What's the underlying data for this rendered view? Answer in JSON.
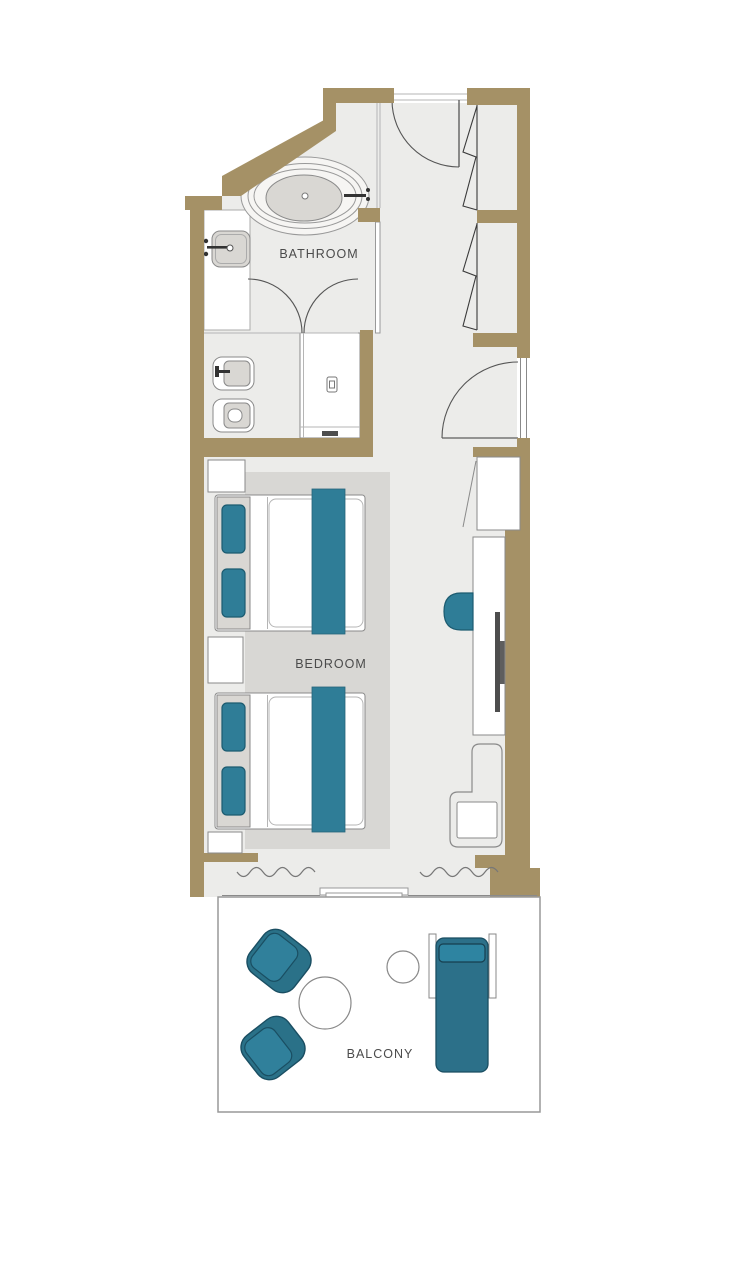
{
  "palette": {
    "wall": "#A59166",
    "floor": "#ECECEA",
    "rug": "#D8D7D4",
    "fixture": "#D9D7D3",
    "teal": "#2F7D97",
    "tealDark": "#1C5B70",
    "tealOuter": "#2A7188",
    "tealLight": "#30809B",
    "line": "#8A8A8A",
    "tv": "#4D4D4D",
    "tvMount": "#5E5E5E",
    "text": "#4B4B4B",
    "white": "#FFFFFF"
  },
  "labels": {
    "bathroom": "BATHROOM",
    "bedroom": "BEDROOM",
    "balcony": "BALCONY"
  },
  "legend": {
    "type": "hotel-room-floor-plan",
    "rooms": [
      "Bathroom",
      "Bedroom",
      "Balcony",
      "Entry corridor",
      "WC / shower room"
    ],
    "bathroom_fixtures": [
      "freestanding-oval-bathtub",
      "washbasin-with-faucet",
      "bidet",
      "toilet",
      "walk-in-shower"
    ],
    "bedroom_furniture": [
      "double-bed-1",
      "double-bed-2",
      "teal-pillows",
      "teal-bed-runners",
      "nightstand-1",
      "nightstand-2",
      "nightstand-3",
      "area-rug",
      "console-desk",
      "wall-tv",
      "desk-chair",
      "armchair-with-side-table",
      "wardrobe-bifold-1",
      "wardrobe-bifold-2",
      "wardrobe-hinged"
    ],
    "balcony_furniture": [
      "tub-chair-1",
      "tub-chair-2",
      "round-coffee-table",
      "round-side-table",
      "sun-lounger"
    ],
    "doors": [
      "entry-door",
      "double-swing-bathroom-doors",
      "connecting-door",
      "sliding-balcony-door"
    ],
    "window_treatment": "wavy-curtain-symbols"
  }
}
